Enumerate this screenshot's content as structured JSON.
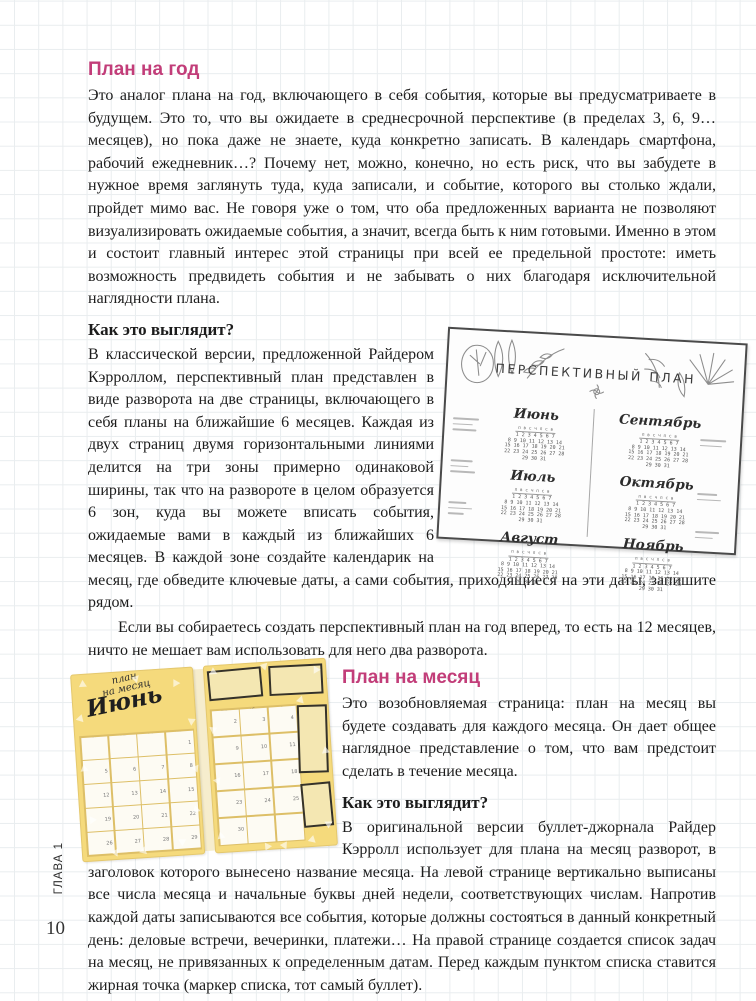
{
  "page": {
    "chapter_label": "ГЛАВА 1",
    "page_number": "10"
  },
  "colors": {
    "heading_pink": "#c23d79",
    "calendar_yellow": "#f5da7c",
    "grid_line": "#e9edef"
  },
  "sections": {
    "plan_year": {
      "heading": "План на год",
      "body": "Это аналог плана на год, включающего в себя события, которые вы предусматриваете в будущем. Это то, что вы ожидаете в среднесрочной перспективе (в пределах 3, 6, 9… месяцев), но пока даже не знаете, куда конкретно записать. В календарь смартфона, рабочий ежедневник…? Почему нет, можно, конечно, но есть риск, что вы забудете в нужное время заглянуть туда, куда записали, и событие, которого вы столько ждали, пройдет мимо вас. Не говоря уже о том, что оба предложенных варианта не позволяют визуализировать ожидаемые события, а значит, всегда быть к ним готовыми. Именно в этом и состоит главный интерес этой страницы при всей ее предельной простоте: иметь возможность предвидеть события и не забывать о них благодаря исключительной наглядности плана."
    },
    "plan_year_how": {
      "heading": "Как это выглядит?",
      "body": "В классической версии, предложенной Райдером Кэрроллом, перспективный план представлен в виде разворота на две страницы, включающего в себя планы на ближайшие 6 месяцев. Каждая из двух страниц двумя горизонтальными линиями делится на три зоны примерно одинаковой ширины, так что на развороте в целом образуется 6 зон, куда вы можете вписать события, ожидаемые вами в каждый из ближайших 6 месяцев. В каждой зоне создайте календарик на месяц, где обведите ключевые даты, а сами события, приходящиеся на эти даты, запишите рядом.",
      "note": "Если вы собираетесь создать перспективный план на год вперед, то есть на 12 месяцев, ничто не мешает вам использовать для него два разворота."
    },
    "plan_month": {
      "heading": "План на месяц",
      "body": "Это возобновляемая страница: план на месяц вы будете создавать для каждого месяца. Он дает общее наглядное представление о том, что вам предстоит сделать в течение месяца.",
      "how_heading": "Как это выглядит?",
      "how_body": "В оригинальной версии буллет-джорнала Райдер Кэрролл использует для плана на месяц разворот, в заголовок которого вынесено название месяца.",
      "how_body_cont": "На левой странице вертикально выписаны все числа месяца и начальные буквы дней недели, соответствующих числам. Напротив каждой даты записываются все события, которые должны состояться в данный конкретный день: деловые встречи, вечеринки, платежи… На правой странице создается список задач на месяц, не привязанных к определенным датам. Перед каждым пунктом списка ставится жирная точка (маркер списка, тот самый буллет)."
    }
  },
  "illustrations": {
    "perspective_plan": {
      "title": "ПЕРСПЕКТИВНЫЙ ПЛАН",
      "months_left": [
        "Июнь",
        "Июль",
        "Август"
      ],
      "months_right": [
        "Сентябрь",
        "Октябрь",
        "Ноябрь"
      ],
      "mini_week_header": "п в с ч п с в",
      "mini_rows": [
        "1 2 3 4 5 6 7",
        "8 9 10 11 12 13 14",
        "15 16 17 18 19 20 21",
        "22 23 24 25 26 27 28",
        "29 30 31"
      ]
    },
    "month_spread": {
      "header_line1": "план",
      "header_line2": "на месяц",
      "month_title": "Июнь",
      "left_day_headers": [
        "пн",
        "вт",
        "ср",
        "чт"
      ],
      "right_day_headers": [
        "пт",
        "сб",
        "вс"
      ],
      "left_dates": [
        [
          "",
          "",
          "",
          "1"
        ],
        [
          "5",
          "6",
          "7",
          "8"
        ],
        [
          "12",
          "13",
          "14",
          "15"
        ],
        [
          "19",
          "20",
          "21",
          "22"
        ],
        [
          "26",
          "27",
          "28",
          "29"
        ]
      ],
      "right_dates": [
        [
          "2",
          "3",
          "4"
        ],
        [
          "9",
          "10",
          "11"
        ],
        [
          "16",
          "17",
          "18"
        ],
        [
          "23",
          "24",
          "25"
        ],
        [
          "30",
          "",
          ""
        ]
      ]
    }
  }
}
